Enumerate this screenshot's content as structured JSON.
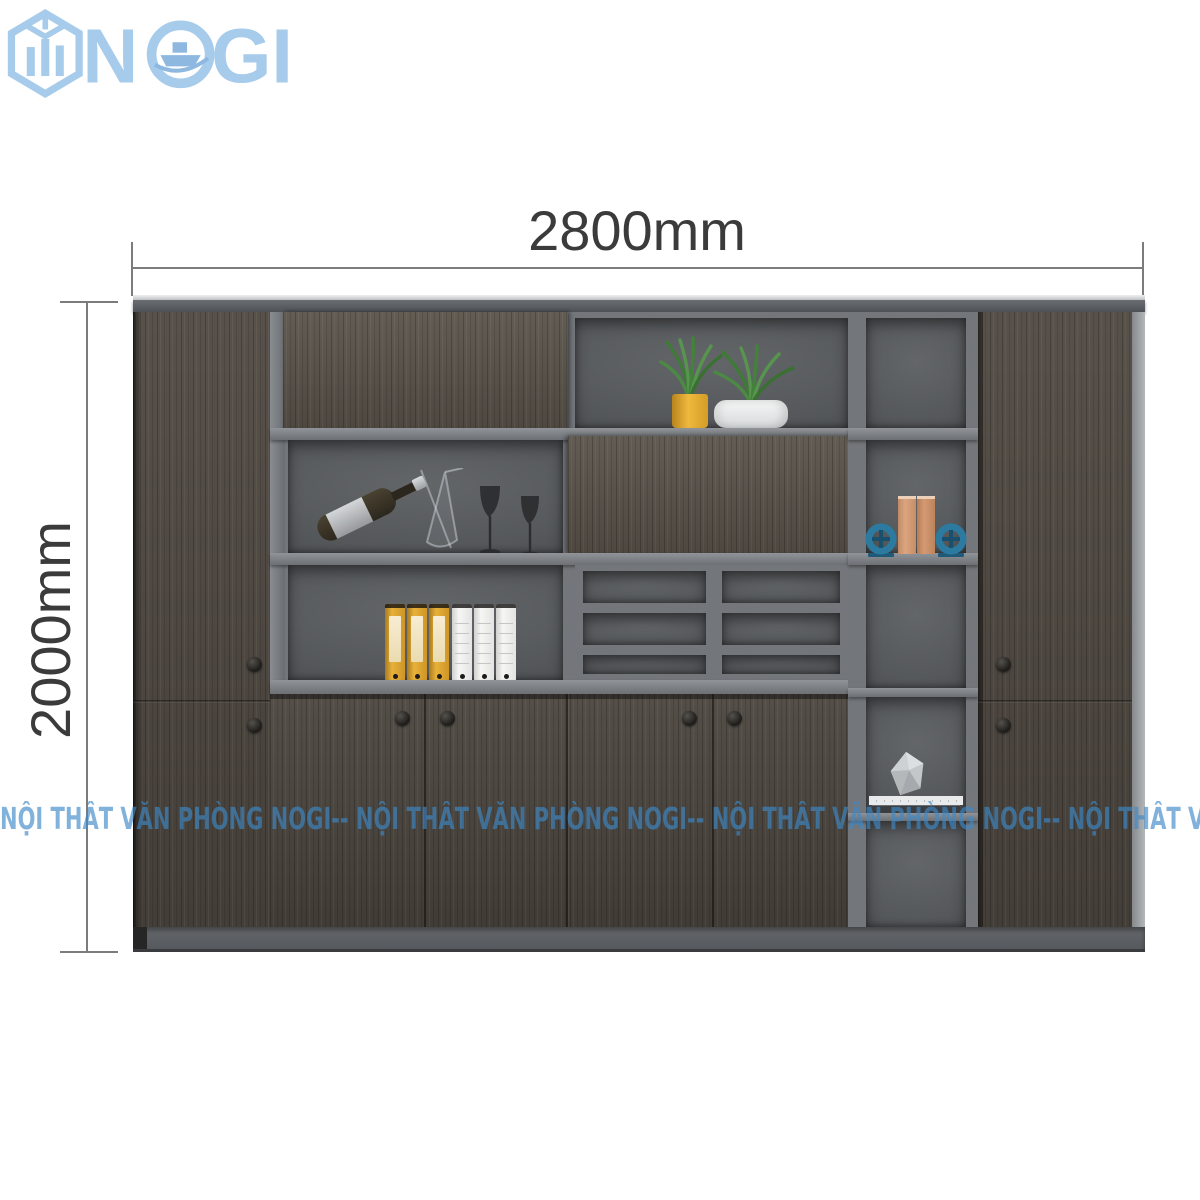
{
  "page": {
    "background": "#ffffff"
  },
  "logo": {
    "text_n": "N",
    "text_gi": "GI",
    "color": "#a6cbeb",
    "icon": "hexagon-buildings-icon",
    "o_glyph": "ship-in-ring-icon"
  },
  "dimensions": {
    "width_label": "2800mm",
    "height_label": "2000mm",
    "line_color": "#7c7c7c",
    "text_color": "#3b3b3b"
  },
  "watermark": {
    "text": "NỘI THẤT VĂN PHÒNG NOGI-- NỘI THẤT VĂN PHÒNG NOGI-- NỘI THẤT VĂN PHÒNG NOGI-- NỘI THẤT VĂN PHÒNG NOGI",
    "color": "rgba(62,136,200,0.65)"
  },
  "cabinet": {
    "wood_color": "#4f4841",
    "frame_color": "#75797d",
    "shelf_back_color": "#56595c",
    "plinth_color": "#5c6064",
    "knob_color": "#26241f",
    "knob_count": 8,
    "shelf_items": {
      "top_shelf": [
        "plant-in-yellow-pot",
        "plant-in-white-pot"
      ],
      "bar_shelf": [
        "wine-bottle",
        "glass-decanter",
        "wine-glass",
        "wine-glass"
      ],
      "binder_shelf": {
        "yellow_binders": 3,
        "white_binders": 3
      },
      "pigeonhole_compartments": 6,
      "book_shelf": {
        "books": 2,
        "round_bookends": 2,
        "bookend_color": "#2c7aa0"
      },
      "decor_shelf": [
        "faceted-stone",
        "magazine-stack"
      ]
    }
  }
}
